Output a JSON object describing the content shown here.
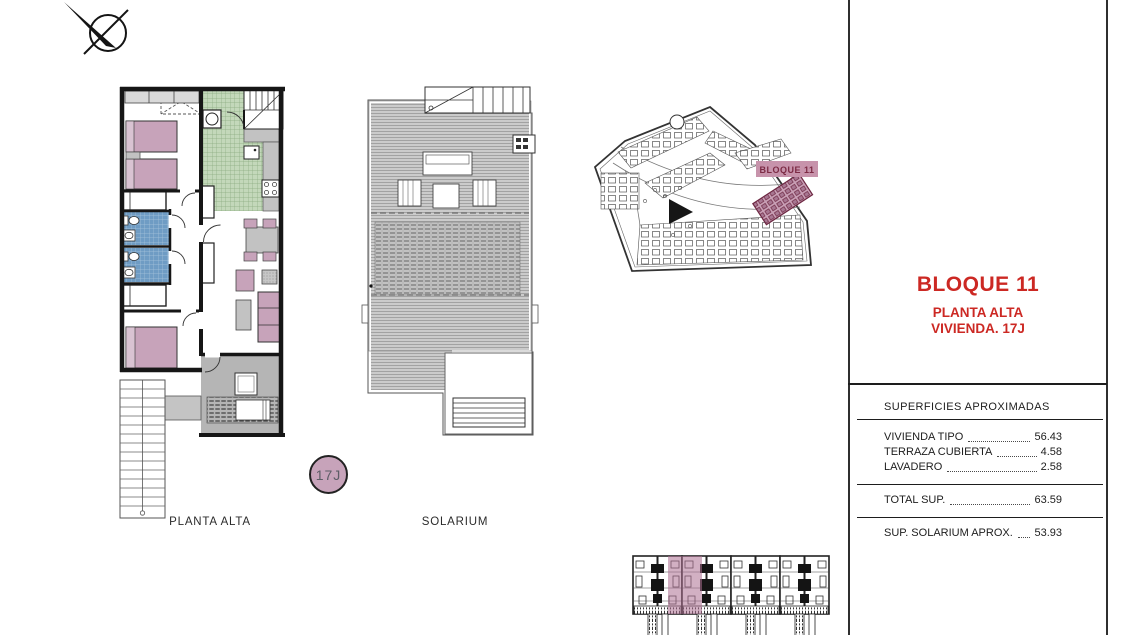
{
  "colors": {
    "accent_red": "#cc2823",
    "room_pink": "#c7a3ba",
    "kitchen_green": "#c3d8ba",
    "bath_blue": "#6f9cc4",
    "terrace_gray": "#b5b5b5",
    "site_label_pink": "#c793ab",
    "site_label_text": "#7c2b45"
  },
  "drawings": {
    "floor_plan": {
      "label": "PLANTA ALTA"
    },
    "solarium": {
      "label": "SOLARIUM"
    },
    "site_plan": {
      "block_label": "BLOQUE 11"
    },
    "unit_badge": "17J"
  },
  "title_block": {
    "title": "BLOQUE 11",
    "subtitle1": "PLANTA ALTA",
    "subtitle2": "VIVIENDA. 17J",
    "table": {
      "header": "SUPERFICIES APROXIMADAS",
      "rows": [
        {
          "label": "VIVIENDA TIPO",
          "value": "56.43"
        },
        {
          "label": "TERRAZA CUBIERTA",
          "value": "4.58"
        },
        {
          "label": "LAVADERO",
          "value": "2.58"
        }
      ],
      "total_row": {
        "label": "TOTAL SUP.",
        "value": "63.59"
      },
      "solarium_row": {
        "label": "SUP. SOLARIUM APROX.",
        "value": "53.93"
      }
    }
  }
}
